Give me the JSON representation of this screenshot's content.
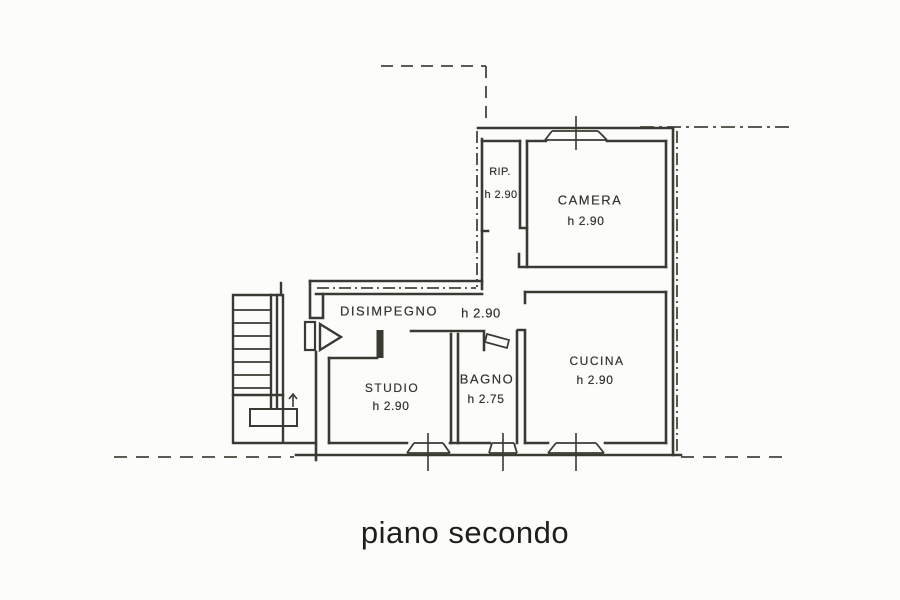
{
  "plan": {
    "caption": "piano secondo",
    "rooms": [
      {
        "name": "RIP.",
        "height": "h 2.90"
      },
      {
        "name": "CAMERA",
        "height": "h 2.90"
      },
      {
        "name": "DISIMPEGNO",
        "height": "h 2.90"
      },
      {
        "name": "STUDIO",
        "height": "h 2.90"
      },
      {
        "name": "BAGNO",
        "height": "h 2.75"
      },
      {
        "name": "CUCINA",
        "height": "h 2.90"
      }
    ],
    "symbols": {
      "entrance_door": "door-swing-icon",
      "interior_door": "door-leaf-icon",
      "window": "window-sill-icon",
      "stair_direction": "up-arrow-icon"
    },
    "colors": {
      "ink": "#3a3a32",
      "paper": "#fcfcfb",
      "caption": "#1e1e1c"
    }
  }
}
